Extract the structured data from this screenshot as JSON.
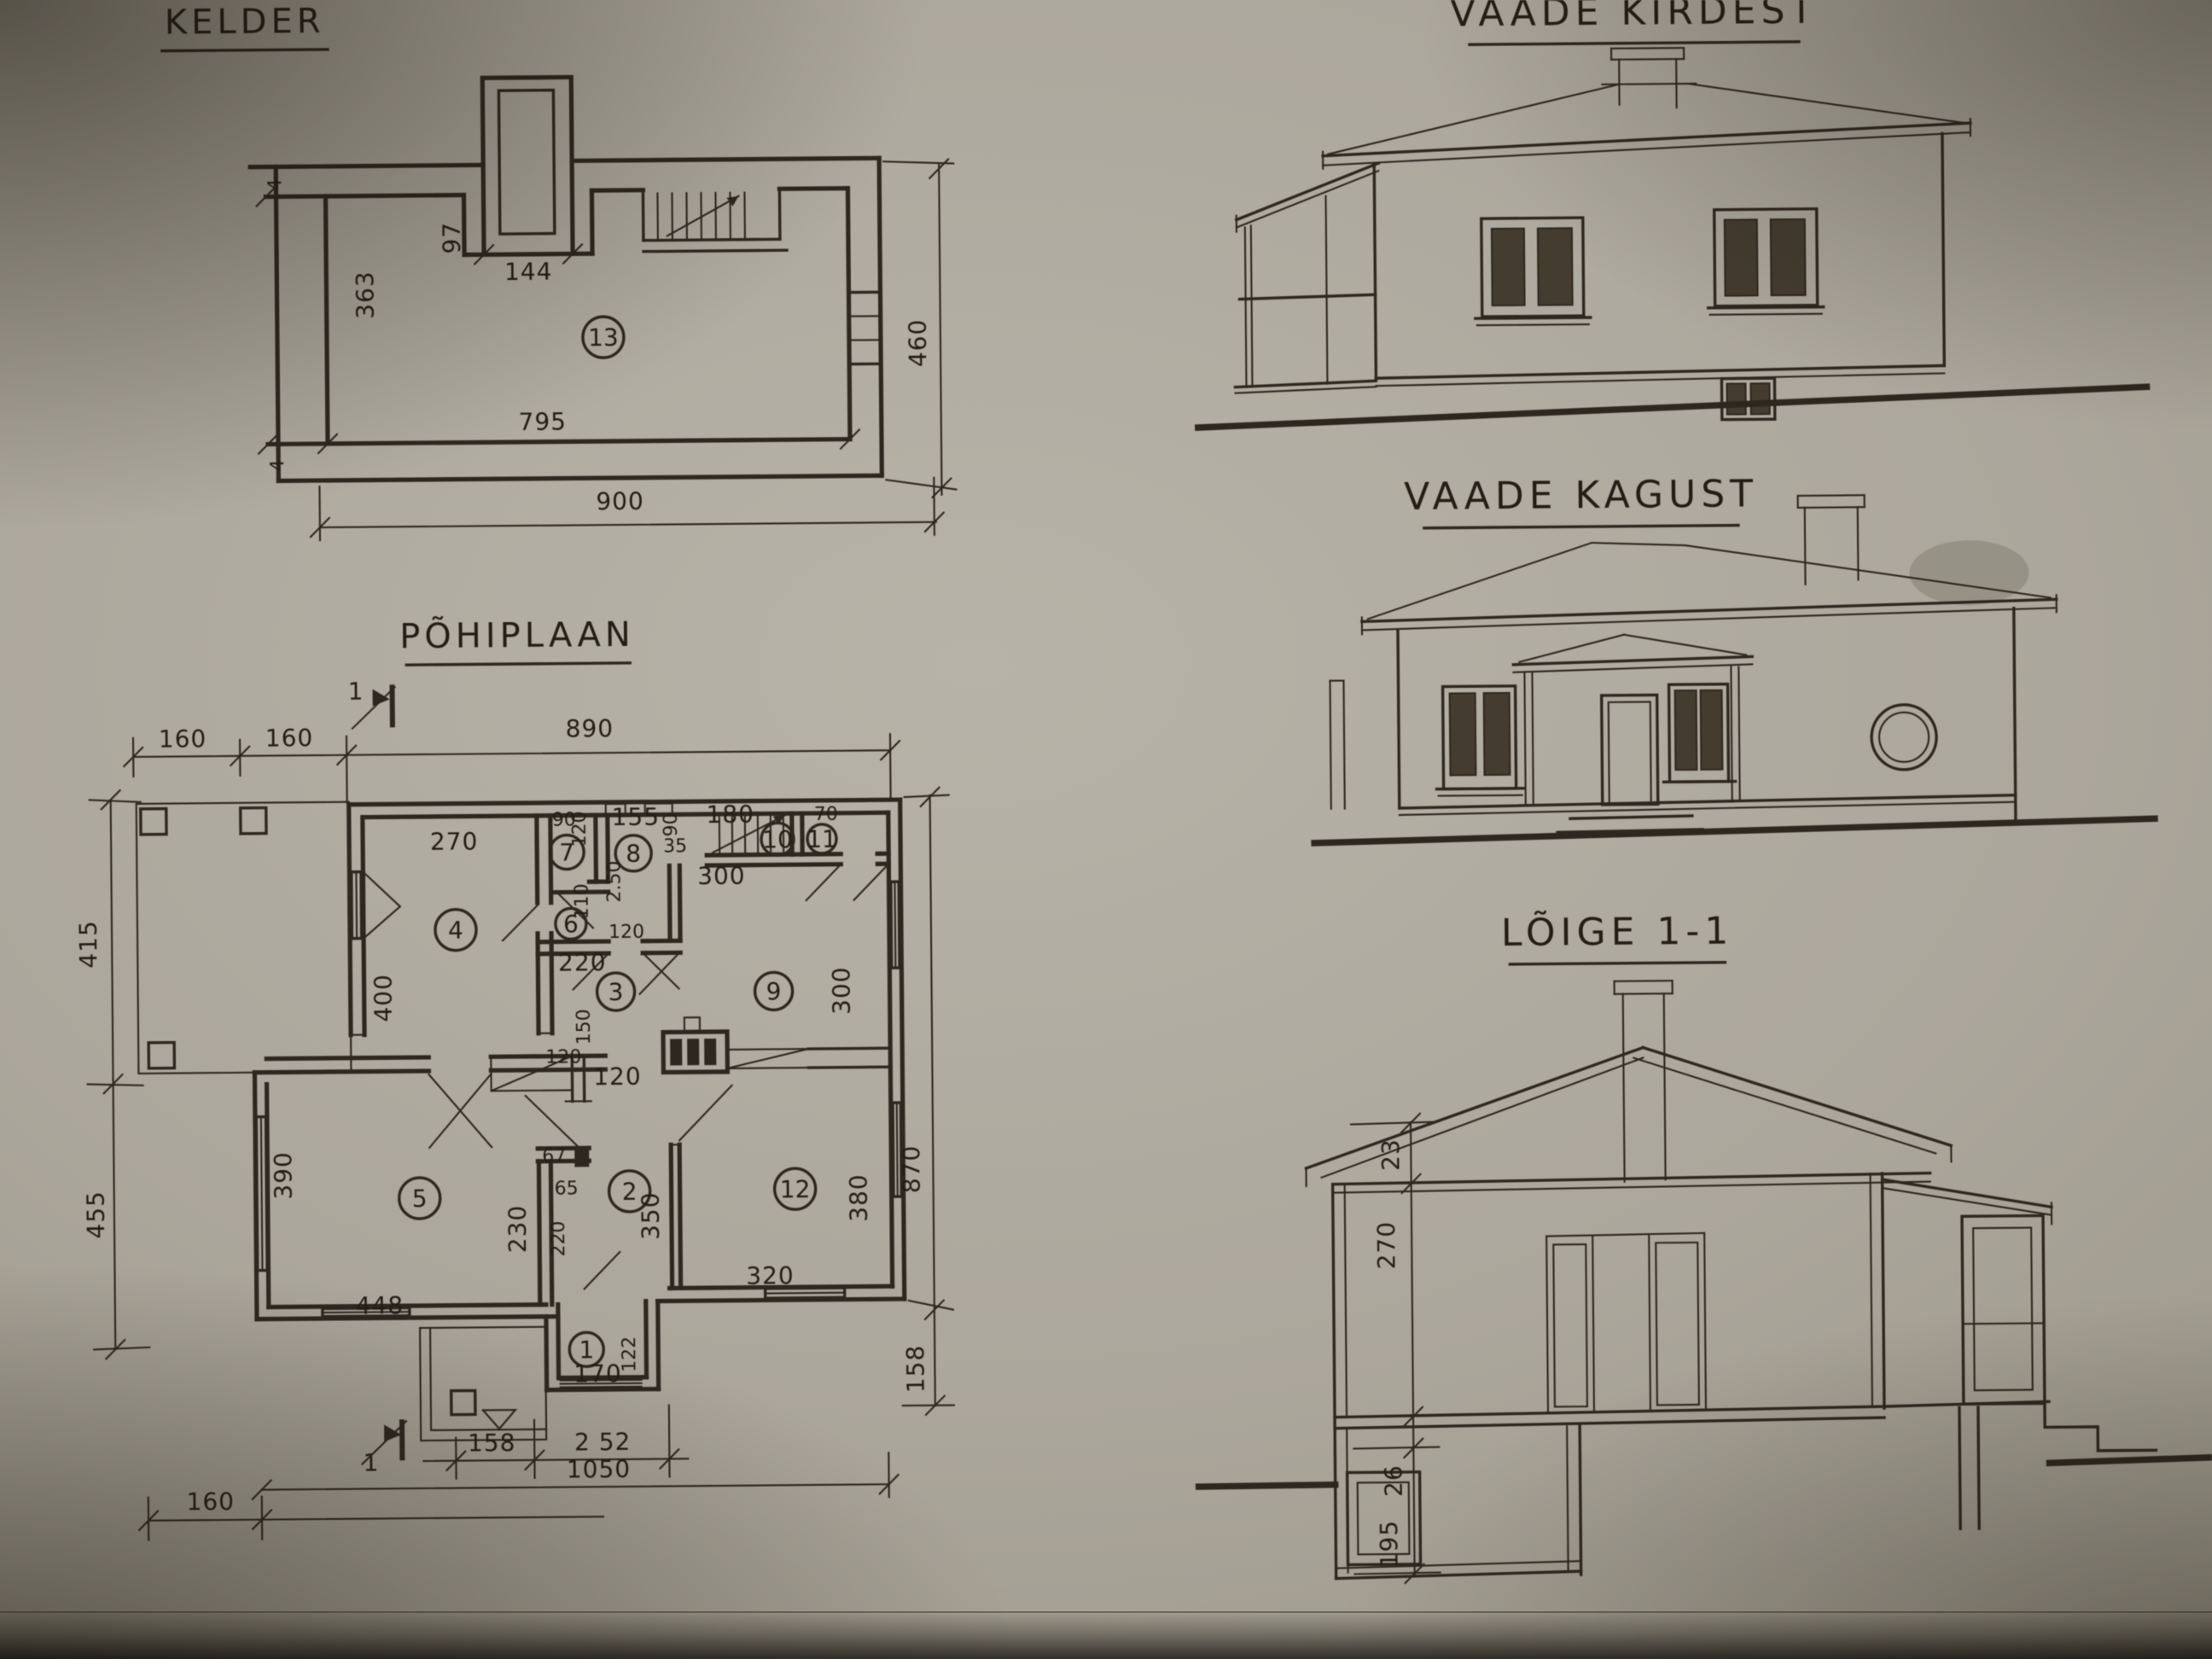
{
  "photo": {
    "paper_center": "#b7b3a8",
    "paper_edge": "#6f6a5d",
    "ink": "#2e2720",
    "glass": "#453c30"
  },
  "kelder": {
    "title": "KELDER",
    "room13": "13",
    "ticks": {
      "top": "4",
      "bottom": "4"
    },
    "dims": {
      "d97": "97",
      "d144": "144",
      "d363": "363",
      "d795": "795",
      "d900": "900",
      "d460": "460"
    }
  },
  "pohiplaan": {
    "title": "PÕHIPLAAN",
    "section_top": "1",
    "section_bottom": "1",
    "rooms": {
      "r1": "1",
      "r2": "2",
      "r3": "3",
      "r4": "4",
      "r5": "5",
      "r6": "6",
      "r7": "7",
      "r8": "8",
      "r9": "9",
      "r10": "10",
      "r11": "11",
      "r12": "12"
    },
    "dims": {
      "top_160a": "160",
      "top_160b": "160",
      "top_890": "890",
      "left_415": "415",
      "left_455": "455",
      "right_870": "870",
      "right_158": "158",
      "bottom_158": "158",
      "bottom_252": "2 52",
      "bottom_1050": "1050",
      "bottom_160": "160",
      "r4_270": "270",
      "r4_400": "400",
      "r7_90": "90",
      "r7_120": "120",
      "r8_155": "155",
      "r8_90": "90",
      "r8_35": "35",
      "r8_250": "2.50",
      "stairs_180": "180",
      "r11_70": "70",
      "hall_300": "300",
      "r6_110": "110",
      "r6_120": "120",
      "r3_220": "220",
      "r3_150": "150",
      "r3_120a": "120",
      "r3_120b": "120",
      "r9_300": "300",
      "r5_390": "390",
      "r5_448": "448",
      "r2_67": "67",
      "r2_65": "65",
      "r2_230": "230",
      "r2_220": "220",
      "r2_350": "350",
      "r12_320": "320",
      "r12_380": "380",
      "r1_170": "170",
      "r1_122": "122"
    }
  },
  "kirdest": {
    "title": "VAADE KIRDEST"
  },
  "kagust": {
    "title": "VAADE KAGUST"
  },
  "loige": {
    "title": "LÕIGE 1-1",
    "dims": {
      "d23": "23",
      "d270": "270",
      "d26": "26",
      "d195": "195"
    }
  }
}
